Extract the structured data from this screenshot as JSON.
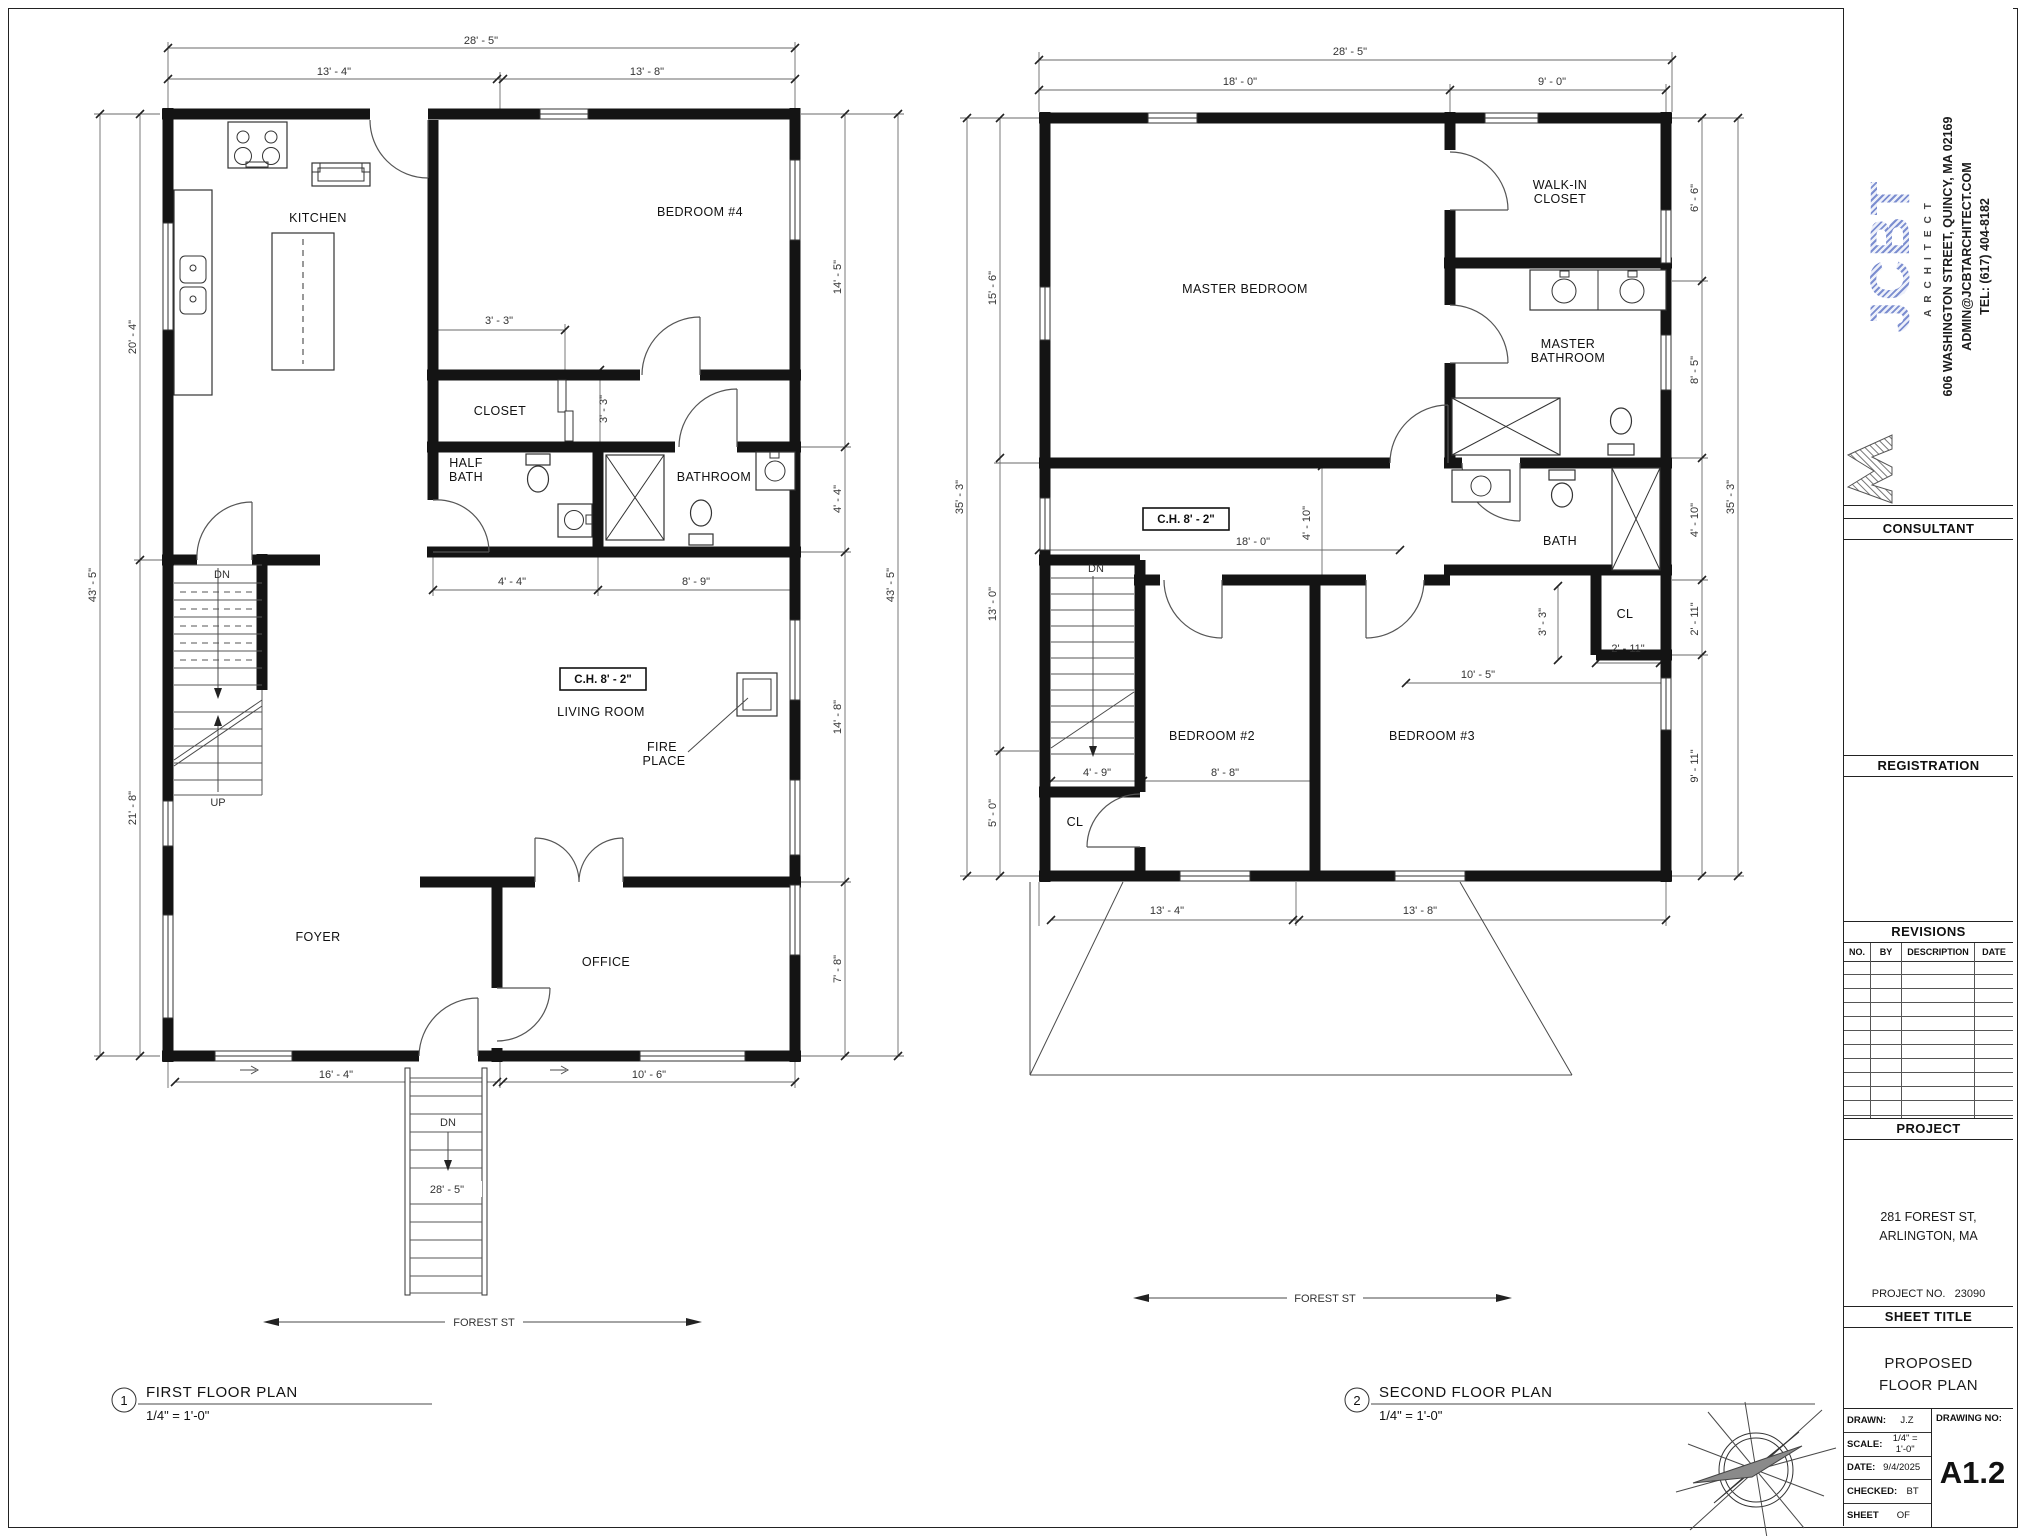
{
  "title_block": {
    "logo": {
      "jc": "JC",
      "bt": "BT",
      "tagline": "ARCHITECT",
      "address_line1": "606 WASHINGTON STREET, QUINCY, MA 02169",
      "address_line2": "ADMIN@JCBTARCHITECT.COM",
      "address_line3": "TEL: (617) 404-8182"
    },
    "sections": {
      "consultant": "CONSULTANT",
      "registration": "REGISTRATION",
      "revisions": "REVISIONS",
      "project": "PROJECT",
      "sheet_title": "SHEET TITLE"
    },
    "revisions_header": {
      "no": "NO.",
      "by": "BY",
      "description": "DESCRIPTION",
      "date": "DATE"
    },
    "project": {
      "address_line1": "281 FOREST ST,",
      "address_line2": "ARLINGTON, MA",
      "number_label": "PROJECT NO.",
      "number": "23090"
    },
    "sheet": {
      "title_line1": "PROPOSED",
      "title_line2": "FLOOR PLAN"
    },
    "info": {
      "drawn_label": "DRAWN:",
      "drawn": "J.Z",
      "scale_label": "SCALE:",
      "scale": "1/4\" = 1'-0\"",
      "date_label": "DATE:",
      "date": "9/4/2025",
      "checked_label": "CHECKED:",
      "checked": "BT",
      "sheet_label": "SHEET",
      "sheet_of": "OF",
      "drawing_no_label": "DRAWING NO:",
      "drawing_no": "A1.2"
    }
  },
  "first_floor": {
    "callout": {
      "num": "1",
      "title": "FIRST FLOOR PLAN",
      "scale": "1/4\" = 1'-0\""
    },
    "rooms": {
      "kitchen": "KITCHEN",
      "bedroom4": "BEDROOM #4",
      "closet": "CLOSET",
      "half_bath_1": "HALF",
      "half_bath_2": "BATH",
      "bathroom": "BATHROOM",
      "living": "LIVING ROOM",
      "foyer": "FOYER",
      "office": "OFFICE"
    },
    "labels": {
      "ch": "C.H. 8' - 2\"",
      "fire_1": "FIRE",
      "fire_2": "PLACE",
      "dn": "DN",
      "up": "UP",
      "entry_dn": "DN",
      "street": "FOREST ST"
    },
    "dims": {
      "top_overall": "28' - 5\"",
      "top_left": "13' - 4\"",
      "top_right": "13' - 8\"",
      "left_overall": "43' - 5\"",
      "left_upper": "20' - 4\"",
      "left_lower": "21' - 8\"",
      "right_overall": "43' - 5\"",
      "right_1": "14' - 5\"",
      "right_2": "4' - 4\"",
      "right_3": "14' - 8\"",
      "right_4": "7' - 8\"",
      "closet_w": "3' - 3\"",
      "closet_d": "3' - 3\"",
      "half_bath_w": "4' - 4\"",
      "bath_w": "8' - 9\"",
      "bottom_left": "16' - 4\"",
      "bottom_right": "10' - 6\"",
      "entry_stair": "28' - 5\""
    }
  },
  "second_floor": {
    "callout": {
      "num": "2",
      "title": "SECOND FLOOR PLAN",
      "scale": "1/4\" = 1'-0\""
    },
    "rooms": {
      "master": "MASTER BEDROOM",
      "walk_in_1": "WALK-IN",
      "walk_in_2": "CLOSET",
      "master_bath_1": "MASTER",
      "master_bath_2": "BATHROOM",
      "bath": "BATH",
      "bedroom2": "BEDROOM #2",
      "bedroom3": "BEDROOM #3",
      "closet_left": "CL",
      "closet_right": "CL"
    },
    "labels": {
      "ch": "C.H. 8' - 2\"",
      "dn": "DN",
      "street": "FOREST ST"
    },
    "dims": {
      "top_overall": "28' - 5\"",
      "top_left": "18' - 0\"",
      "top_right": "9' - 0\"",
      "left_overall": "35' - 3\"",
      "left_1": "15' - 6\"",
      "left_2": "13' - 0\"",
      "left_3": "5' - 0\"",
      "right_overall": "35' - 3\"",
      "right_1": "6' - 6\"",
      "right_2": "8' - 5\"",
      "right_3": "4' - 10\"",
      "right_4": "2' - 11\"",
      "right_5": "9' - 11\"",
      "hall_w": "18' - 0\"",
      "hall_d": "4' - 10\"",
      "closet3_d": "3' - 3\"",
      "bedroom3_w": "10' - 5\"",
      "closet3_w": "2' - 11\"",
      "closet2_w": "4' - 9\"",
      "bedroom2_w": "8' - 8\"",
      "bottom_left": "13' - 4\"",
      "bottom_right": "13' - 8\""
    }
  }
}
